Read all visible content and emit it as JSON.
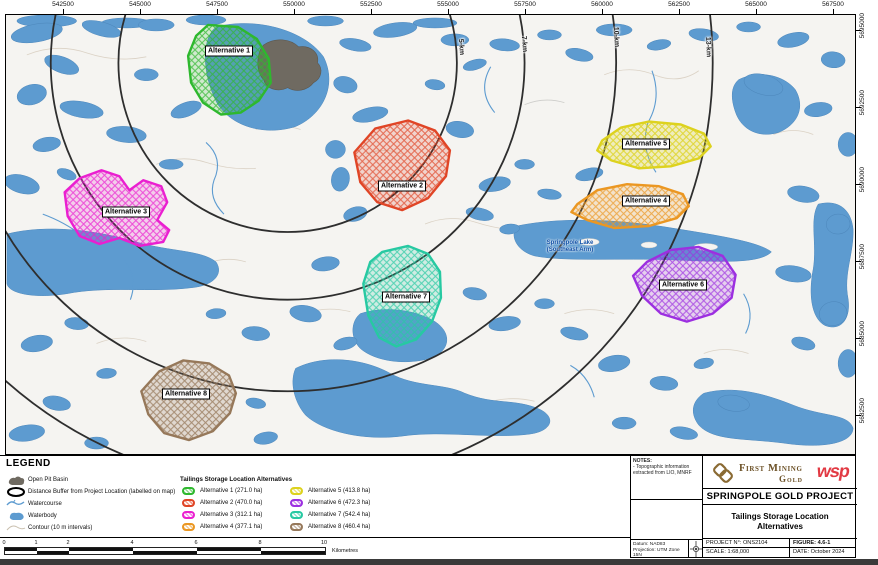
{
  "map": {
    "top_axis_labels": [
      "542500",
      "545000",
      "547500",
      "550000",
      "552500",
      "555000",
      "557500",
      "560000",
      "562500",
      "565000",
      "567500"
    ],
    "right_axis_labels": [
      "5695000",
      "5692500",
      "5690000",
      "5687500",
      "5685000",
      "5682500"
    ],
    "buffer_rings": [
      {
        "label": "5-km"
      },
      {
        "label": "7-km"
      },
      {
        "label": "10-km"
      },
      {
        "label": "13-km"
      }
    ],
    "lake_label": {
      "line1": "Springpole Lake",
      "line2": "(Southeast Arm)"
    },
    "alternatives": [
      {
        "name": "Alternative 1",
        "area_ha": "271.0",
        "color": "#2eb82e"
      },
      {
        "name": "Alternative 2",
        "area_ha": "470.0",
        "color": "#e04526"
      },
      {
        "name": "Alternative 3",
        "area_ha": "312.1",
        "color": "#ea1fd0"
      },
      {
        "name": "Alternative 4",
        "area_ha": "377.1",
        "color": "#eb9722"
      },
      {
        "name": "Alternative 5",
        "area_ha": "413.8",
        "color": "#ddd21e"
      },
      {
        "name": "Alternative 6",
        "area_ha": "472.3",
        "color": "#9c2fe0"
      },
      {
        "name": "Alternative 7",
        "area_ha": "542.4",
        "color": "#27c9a2"
      },
      {
        "name": "Alternative 8",
        "area_ha": "460.4",
        "color": "#96785a"
      }
    ],
    "water_color": "#5d9bd0",
    "open_pit_color": "#6f6a61"
  },
  "legend": {
    "title": "LEGEND",
    "items": [
      "Open Pit Basin",
      "Distance Buffer from Project Location (labelled on map)",
      "Watercourse",
      "Waterbody",
      "Contour (10 m intervals)"
    ],
    "alt_title": "Tailings Storage Location Alternatives",
    "alt_items": [
      "Alternative 1 (271.0 ha)",
      "Alternative 2 (470.0 ha)",
      "Alternative 3 (312.1 ha)",
      "Alternative 4 (377.1 ha)",
      "Alternative 5 (413.8 ha)",
      "Alternative 6 (472.3 ha)",
      "Alternative 7 (542.4 ha)",
      "Alternative 8 (460.4 ha)"
    ]
  },
  "scale_bar": {
    "tick_labels": [
      "0",
      "1",
      "2",
      "4",
      "6",
      "8",
      "10"
    ],
    "unit": "Kilometres"
  },
  "title_block": {
    "notes_title": "NOTES:",
    "notes_body": "- Topographic information extracted from LIO, MNRF",
    "company_line1": "First Mining",
    "company_line2": "Gold",
    "partner": "wsp",
    "project": "SPRINGPOLE GOLD PROJECT",
    "figure_title_line1": "Tailings Storage Location",
    "figure_title_line2": "Alternatives",
    "datum_line1": "Datum: NAD83",
    "datum_line2": "Projection: UTM Zone 15N",
    "project_no_label": "PROJECT N°:",
    "project_no": "ONS2104",
    "figure_label": "FIGURE:",
    "figure_no": "4.6-1",
    "scale_label": "SCALE:",
    "scale_value": "1:68,000",
    "date_label": "DATE:",
    "date_value": "October 2024"
  }
}
